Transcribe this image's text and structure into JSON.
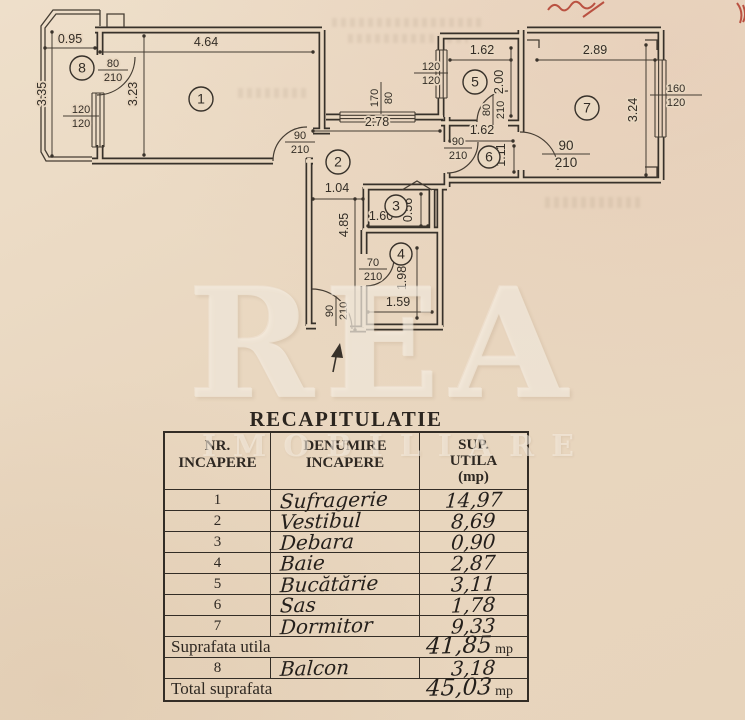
{
  "plan": {
    "rooms": [
      "1",
      "2",
      "3",
      "4",
      "5",
      "6",
      "7",
      "8"
    ],
    "dims": [
      "0.95",
      "4.64",
      "3.35",
      "3.23",
      "2.78",
      "1.04",
      "4.85",
      "1.60",
      "0.56",
      "1.98",
      "1.59",
      "1.62",
      "2.00",
      "1.62",
      "1.11",
      "2.89",
      "3.24"
    ],
    "fractions": [
      {
        "num": "80",
        "den": "210"
      },
      {
        "num": "120",
        "den": "120"
      },
      {
        "num": "90",
        "den": "210"
      },
      {
        "num": "170",
        "den": "80"
      },
      {
        "num": "120",
        "den": "120"
      },
      {
        "num": "80",
        "den": "210"
      },
      {
        "num": "90",
        "den": "210"
      },
      {
        "num": "90",
        "den": "210"
      },
      {
        "num": "160",
        "den": "120"
      },
      {
        "num": "70",
        "den": "210"
      },
      {
        "num": "90",
        "den": "210"
      }
    ]
  },
  "watermark": {
    "main": "REA",
    "sub": "IMOBILIARE"
  },
  "table": {
    "title": "RECAPITULATIE",
    "header": {
      "c1a": "NR.",
      "c1b": "INCAPERE",
      "c2a": "DENUMIRE",
      "c2b": "INCAPERE",
      "c3a": "SUP.",
      "c3b": "UTILA",
      "c3c": "(mp)"
    },
    "rows": [
      {
        "nr": "1",
        "name": "Sufragerie",
        "value": "14,97"
      },
      {
        "nr": "2",
        "name": "Vestibul",
        "value": "8,69"
      },
      {
        "nr": "3",
        "name": "Debara",
        "value": "0,90"
      },
      {
        "nr": "4",
        "name": "Baie",
        "value": "2,87"
      },
      {
        "nr": "5",
        "name": "Bucătărie",
        "value": "3,11"
      },
      {
        "nr": "6",
        "name": "Sas",
        "value": "1,78"
      },
      {
        "nr": "7",
        "name": "Dormitor",
        "value": "9,33"
      }
    ],
    "suprafata": {
      "label": "Suprafata utila",
      "value": "41,85",
      "unit": "mp"
    },
    "balcon": {
      "nr": "8",
      "name": "Balcon",
      "value": "3,18"
    },
    "total": {
      "label": "Total suprafata",
      "value": "45,03",
      "unit": "mp"
    }
  }
}
